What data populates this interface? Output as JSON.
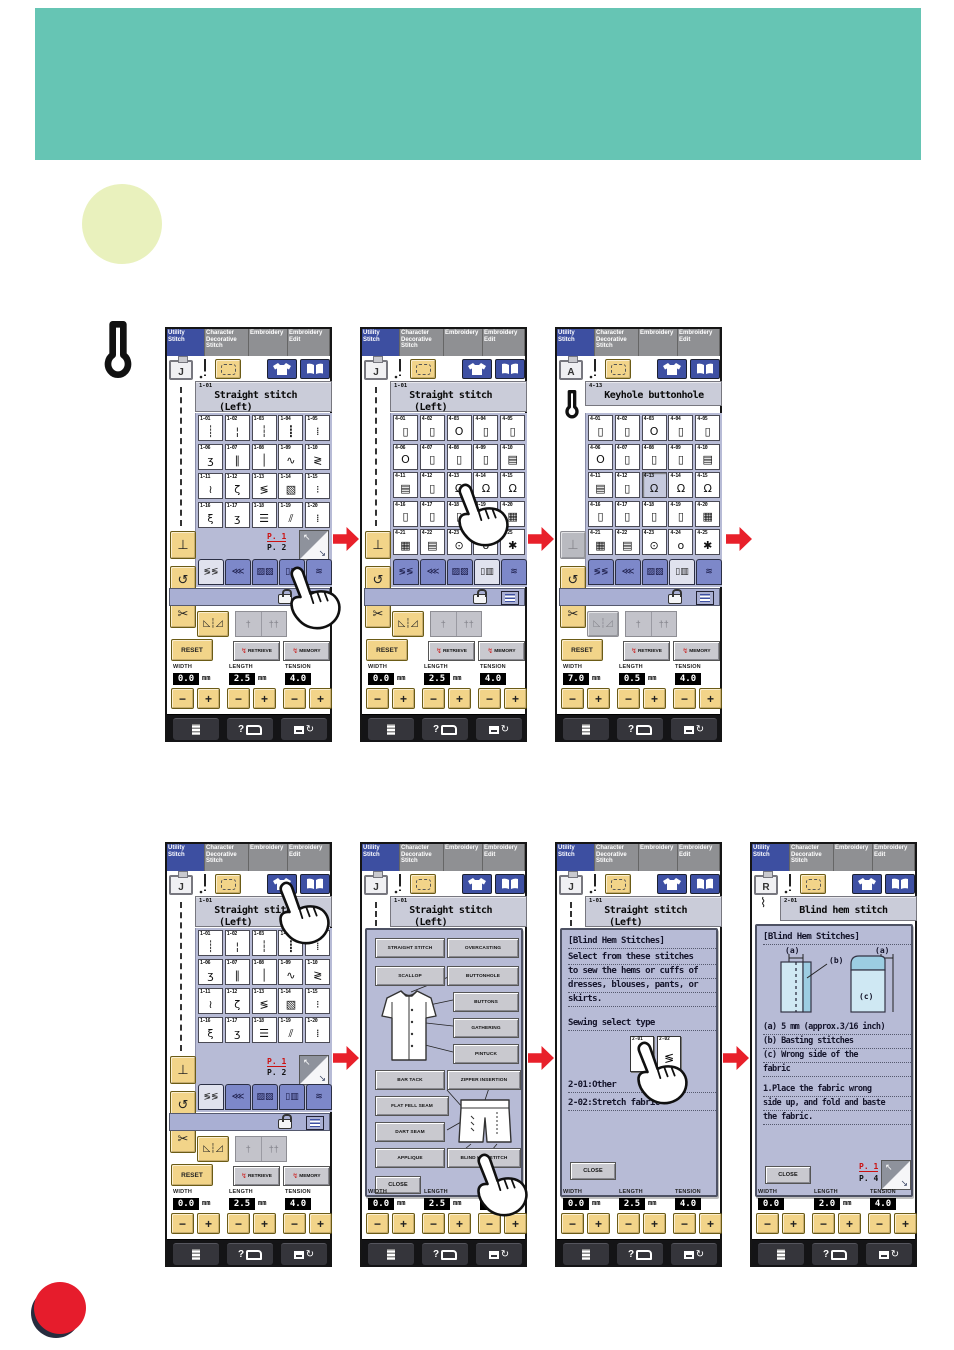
{
  "page": {
    "bg": "#ffffff",
    "header_color": "#66c5b4",
    "highlight_circle_color": "#e9f1bd",
    "arrow_color": "#e8202a",
    "dot_color": "#e61c2c"
  },
  "mode_tabs": [
    {
      "label": "Utility\nStitch",
      "selected": true
    },
    {
      "label": "Character\nDecorative\nStitch",
      "selected": false
    },
    {
      "label": "Embroidery",
      "selected": false
    },
    {
      "label": "Embroidery\nEdit",
      "selected": false
    }
  ],
  "labels": {
    "width": "WIDTH",
    "length": "LENGTH",
    "tension": "TENSION",
    "mm": "mm",
    "reset": "RESET",
    "retrieve": "RETRIEVE",
    "memory": "MEMORY",
    "close": "CLOSE",
    "minus": "−",
    "plus": "+",
    "pivot": "⊥",
    "uturn": "↺",
    "scissors": "✂",
    "mirror": "◺┆◿",
    "needle_single": "†",
    "needle_twin": "††",
    "help": "?",
    "rotate": "↻",
    "nw_arrow": "↖",
    "se_arrow": "↘"
  },
  "category_tabs": [
    "≶≶",
    "⋘",
    "▨▨",
    "▯▥",
    "≋"
  ],
  "stitch_grid_1": [
    {
      "code": "1-01",
      "glyph": "┊"
    },
    {
      "code": "1-02",
      "glyph": "¦"
    },
    {
      "code": "1-03",
      "glyph": "┆"
    },
    {
      "code": "1-04",
      "glyph": "┋"
    },
    {
      "code": "1-05",
      "glyph": "⁞"
    },
    {
      "code": "1-06",
      "glyph": "ʒ"
    },
    {
      "code": "1-07",
      "glyph": "∥"
    },
    {
      "code": "1-08",
      "glyph": "│"
    },
    {
      "code": "1-09",
      "glyph": "∿"
    },
    {
      "code": "1-10",
      "glyph": "≷"
    },
    {
      "code": "1-11",
      "glyph": "≀"
    },
    {
      "code": "1-12",
      "glyph": "ζ"
    },
    {
      "code": "1-13",
      "glyph": "≶"
    },
    {
      "code": "1-14",
      "glyph": "▧"
    },
    {
      "code": "1-15",
      "glyph": "⁝"
    },
    {
      "code": "1-16",
      "glyph": "ξ"
    },
    {
      "code": "1-17",
      "glyph": "ʒ"
    },
    {
      "code": "1-18",
      "glyph": "☰"
    },
    {
      "code": "1-19",
      "glyph": "⫽"
    },
    {
      "code": "1-20",
      "glyph": "⁞"
    }
  ],
  "stitch_grid_4": [
    {
      "code": "4-01",
      "glyph": "▯"
    },
    {
      "code": "4-02",
      "glyph": "▯"
    },
    {
      "code": "4-03",
      "glyph": "O"
    },
    {
      "code": "4-04",
      "glyph": "▯"
    },
    {
      "code": "4-05",
      "glyph": "▯"
    },
    {
      "code": "4-06",
      "glyph": "O"
    },
    {
      "code": "4-07",
      "glyph": "▯"
    },
    {
      "code": "4-08",
      "glyph": "▯"
    },
    {
      "code": "4-09",
      "glyph": "▯"
    },
    {
      "code": "4-10",
      "glyph": "▤"
    },
    {
      "code": "4-11",
      "glyph": "▤"
    },
    {
      "code": "4-12",
      "glyph": "▯"
    },
    {
      "code": "4-13",
      "glyph": "Ω"
    },
    {
      "code": "4-14",
      "glyph": "Ω"
    },
    {
      "code": "4-15",
      "glyph": "Ω"
    },
    {
      "code": "4-16",
      "glyph": "▯"
    },
    {
      "code": "4-17",
      "glyph": "▯"
    },
    {
      "code": "4-18",
      "glyph": "▯"
    },
    {
      "code": "4-19",
      "glyph": "▯"
    },
    {
      "code": "4-20",
      "glyph": "▦"
    },
    {
      "code": "4-21",
      "glyph": "▦"
    },
    {
      "code": "4-22",
      "glyph": "▤"
    },
    {
      "code": "4-23",
      "glyph": "⊙"
    },
    {
      "code": "4-24",
      "glyph": "o"
    },
    {
      "code": "4-25",
      "glyph": "✱"
    }
  ],
  "select_dialog": {
    "rows_left": [
      "STRAIGHT STITCH",
      "SCALLOP",
      "BAR TACK",
      "FLAT FELL SEAM",
      "DART SEAM",
      "APPLIQUE"
    ],
    "rows_right": [
      "OVERCASTING",
      "BUTTONHOLE",
      "BUTTONS",
      "GATHERING",
      "PINTUCK",
      "ZIPPER INSERTION",
      "BLIND HEM STITCH"
    ]
  },
  "info_dialog": {
    "heading": "[Blind Hem Stitches]",
    "lines": [
      "Select from these stitches",
      "to sew the hems or cuffs of",
      "dresses, blouses, pants, or",
      "skirts."
    ],
    "select_label": "Sewing select type",
    "options": [
      {
        "code": "2-01",
        "glyph": "⌇"
      },
      {
        "code": "2-02",
        "glyph": "≶"
      }
    ],
    "option_lines": [
      "2-01:Other",
      "2-02:Stretch fabric"
    ]
  },
  "blind_dialog": {
    "heading": "[Blind Hem Stitches]",
    "label_a": "(a)",
    "label_b": "(b)",
    "label_c": "(c)",
    "lines": [
      "(a) 5 mm (approx.3/16 inch)",
      "(b) Basting stitches",
      "(c) Wrong side of the",
      "fabric"
    ],
    "steps": [
      "1.Place the fabric wrong",
      "side up, and fold and baste",
      "the fabric."
    ]
  },
  "panels": [
    {
      "x": 165,
      "y": 327,
      "w": 167,
      "h": 415,
      "foot_letter": "J",
      "sidebar": "dotted",
      "title_code": "1-01",
      "title": "Straight stitch",
      "title2": "(Left)",
      "grid": "stitch_grid_1",
      "grid_rows": 4,
      "selected_cell": "",
      "page": {
        "current": "P. 1",
        "next": "P. 2"
      },
      "selected_cat": 0,
      "pivot_enabled": true,
      "mirror_enabled": true,
      "dialog": "",
      "values": {
        "width": "0.0",
        "width_unit": "mm",
        "length": "2.5",
        "length_unit": "mm",
        "tension": "4.0"
      },
      "hand": {
        "x": 126,
        "y": 240
      }
    },
    {
      "x": 360,
      "y": 327,
      "w": 167,
      "h": 415,
      "foot_letter": "J",
      "sidebar": "dotted",
      "title_code": "1-01",
      "title": "Straight stitch",
      "title2": "(Left)",
      "grid": "stitch_grid_4",
      "grid_rows": 5,
      "selected_cell": "",
      "page": null,
      "selected_cat": 3,
      "pivot_enabled": true,
      "mirror_enabled": true,
      "dialog": "",
      "values": {
        "width": "0.0",
        "width_unit": "mm",
        "length": "2.5",
        "length_unit": "mm",
        "tension": "4.0"
      },
      "hand": {
        "x": 99,
        "y": 157
      }
    },
    {
      "x": 555,
      "y": 327,
      "w": 167,
      "h": 415,
      "foot_letter": "A",
      "sidebar": "keyhole",
      "title_code": "4-13",
      "title": "Keyhole buttonhole",
      "title2": "",
      "grid": "stitch_grid_4",
      "grid_rows": 5,
      "selected_cell": "4-13",
      "page": null,
      "selected_cat": 3,
      "pivot_enabled": false,
      "mirror_enabled": false,
      "dialog": "",
      "values": {
        "width": "7.0",
        "width_unit": "mm",
        "length": "0.5",
        "length_unit": "mm",
        "tension": "4.0"
      },
      "hand": null
    },
    {
      "x": 165,
      "y": 842,
      "w": 167,
      "h": 425,
      "foot_letter": "J",
      "sidebar": "dotted",
      "title_code": "1-01",
      "title": "Straight stitch",
      "title2": "(Left)",
      "grid": "stitch_grid_1",
      "grid_rows": 4,
      "selected_cell": "",
      "page": {
        "current": "P. 1",
        "next": "P. 2"
      },
      "selected_cat": 0,
      "pivot_enabled": true,
      "mirror_enabled": true,
      "dialog": "",
      "values": {
        "width": "0.0",
        "width_unit": "mm",
        "length": "2.5",
        "length_unit": "mm",
        "tension": "4.0"
      },
      "hand": {
        "x": 115,
        "y": 40
      }
    },
    {
      "x": 360,
      "y": 842,
      "w": 167,
      "h": 425,
      "foot_letter": "J",
      "sidebar": "dotted",
      "title_code": "1-01",
      "title": "Straight stitch",
      "title2": "(Left)",
      "grid": "",
      "grid_rows": 0,
      "selected_cell": "",
      "page": null,
      "selected_cat": -1,
      "pivot_enabled": true,
      "mirror_enabled": true,
      "dialog": "select",
      "values": {
        "width": "0.0",
        "width_unit": "mm",
        "length": "2.5",
        "length_unit": "mm",
        "tension": "4.0"
      },
      "hand": {
        "x": 118,
        "y": 312
      }
    },
    {
      "x": 555,
      "y": 842,
      "w": 167,
      "h": 425,
      "foot_letter": "J",
      "sidebar": "dotted",
      "title_code": "1-01",
      "title": "Straight stitch",
      "title2": "(Left)",
      "grid": "",
      "grid_rows": 0,
      "selected_cell": "",
      "page": null,
      "selected_cat": -1,
      "pivot_enabled": true,
      "mirror_enabled": true,
      "dialog": "info",
      "values": {
        "width": "0.0",
        "width_unit": "mm",
        "length": "2.5",
        "length_unit": "mm",
        "tension": "4.0"
      },
      "hand": {
        "x": 83,
        "y": 200
      }
    },
    {
      "x": 750,
      "y": 842,
      "w": 167,
      "h": 425,
      "foot_letter": "R",
      "sidebar": "blindhem",
      "title_code": "2-01",
      "title": "Blind hem stitch",
      "title2": "",
      "grid": "",
      "grid_rows": 0,
      "selected_cell": "",
      "page": {
        "current": "P. 1",
        "next": "P. 4"
      },
      "selected_cat": -1,
      "pivot_enabled": true,
      "mirror_enabled": true,
      "dialog": "blind",
      "values": {
        "width": "0.0",
        "width_unit": "",
        "length": "2.0",
        "length_unit": "mm",
        "tension": "4.0"
      },
      "hand": null
    }
  ]
}
